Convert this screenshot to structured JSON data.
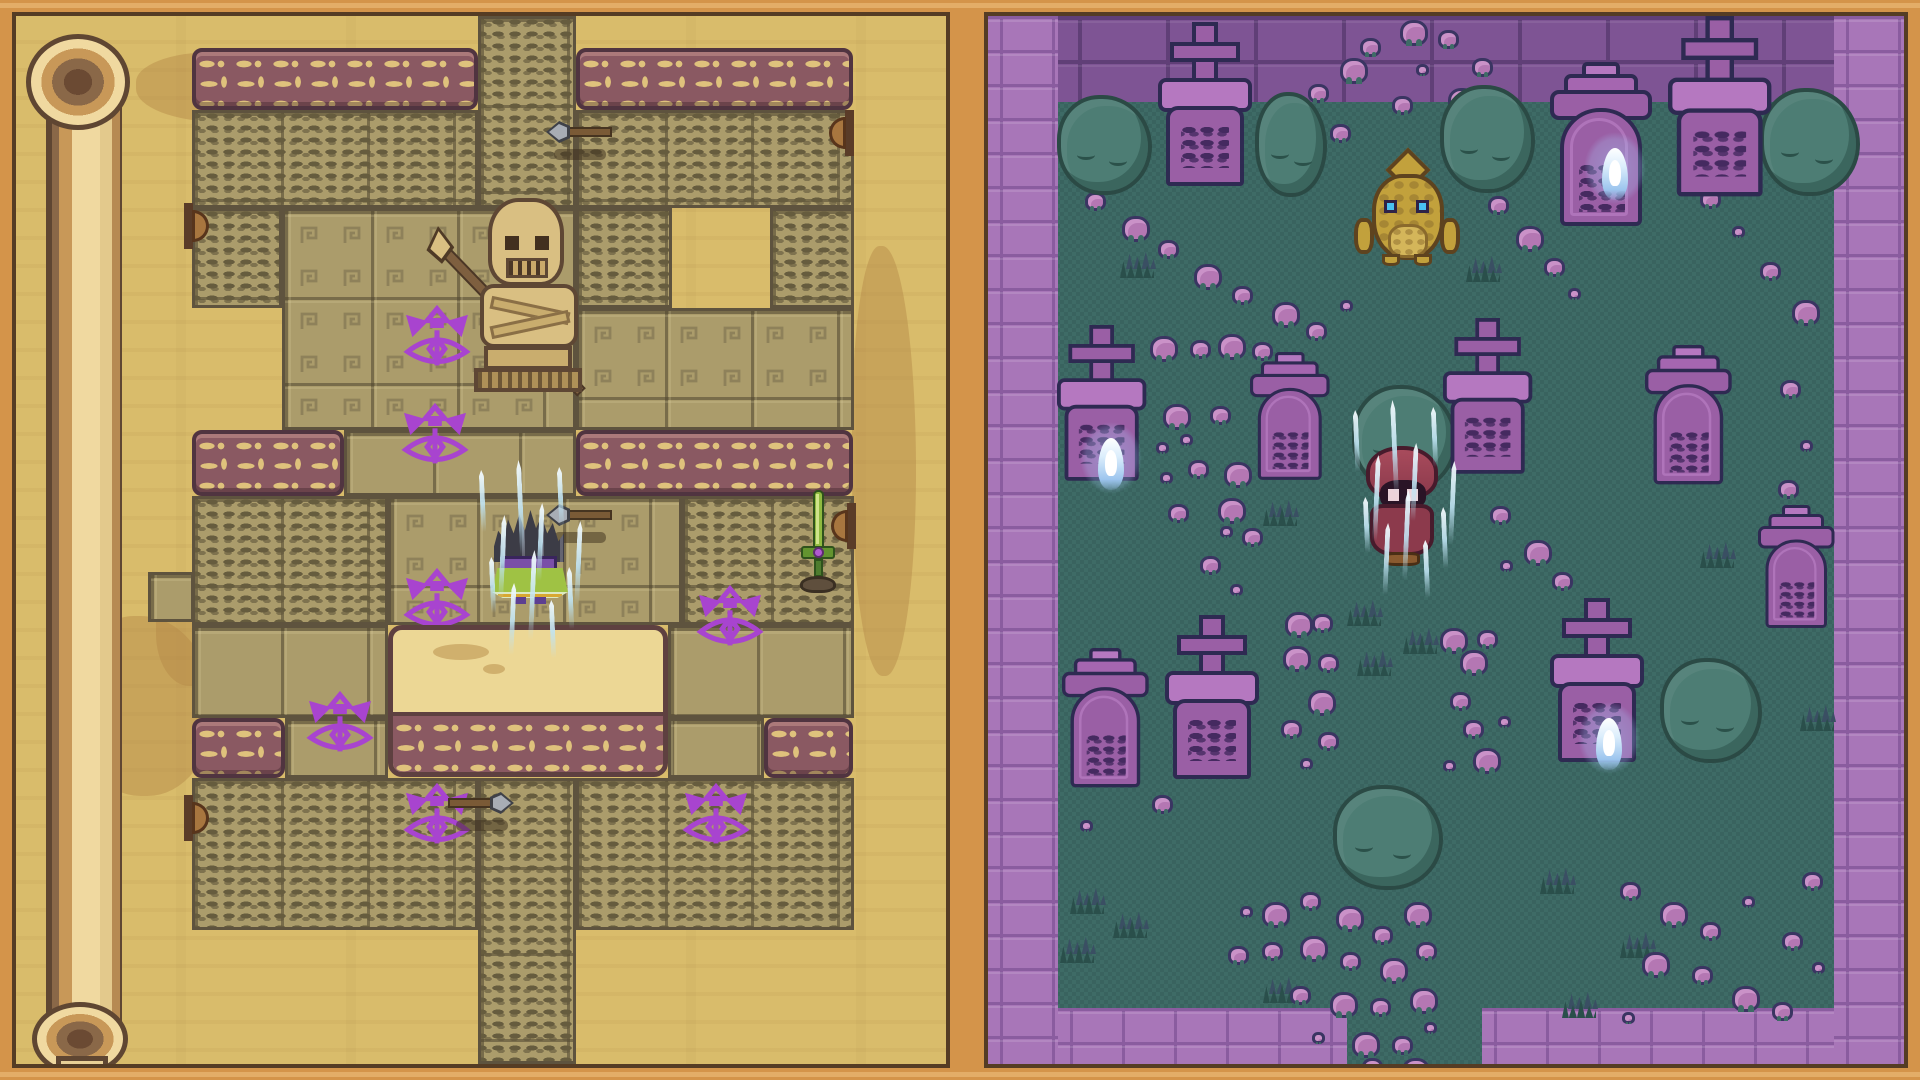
{
  "scene": {
    "kind": "pixel-art game, dual view: temple scroll map (left) and graveyard (right)",
    "width": 1920,
    "height": 1080,
    "visible_text": "none - all markings are decorative glyphs"
  },
  "palette": {
    "frame": "#d4944a",
    "frame-seam": "#553c24",
    "parchment": "#d9bc6b",
    "tile": "#ab9c6b",
    "glyph-mark": "#665c3e",
    "band": "#8a5962",
    "band-border": "#503440",
    "band-glyph": "#dfc27c",
    "plat": "#ecd795",
    "plat-border": "#5e4040",
    "eye": "#a844cf",
    "grass1": "#3e6b66",
    "grass2": "#39635f",
    "wallL": "#a876b8",
    "wallLseam": "#8a5c9f",
    "wallD": "#7e5494",
    "wallDseam": "#603f77",
    "bush": "#4d7d74",
    "bush-dark": "#2b4a45",
    "grave1": "#9a5fa5",
    "grave2": "#b578c0",
    "grave-outline": "#2e2a52",
    "engrave": "#452a60",
    "shroom": "#b477b3",
    "shroom-outline": "#3a3562",
    "tuft": "#2a4f4b",
    "statue": "#d9bf82",
    "statue-shade": "#c9ad6e",
    "statue-outline": "#5e4734",
    "player-cape": "#9fc244",
    "player-purple": "#7a4fa8",
    "hood-red": "#8c3a4c",
    "duck-gold": "#c2a13c",
    "sword-green": "#8fba3f",
    "wisp-blue": "#9cc5ee"
  },
  "left_panel": {
    "label": "temple-scroll-map",
    "origin": [
      16,
      16
    ],
    "blotches": [
      [
        58,
        600,
        140,
        180,
        0.5
      ],
      [
        836,
        230,
        64,
        430,
        0.3
      ],
      [
        120,
        36,
        180,
        70,
        0.4
      ],
      [
        140,
        560,
        70,
        110,
        0.5
      ],
      [
        360,
        300,
        30,
        18,
        0.6
      ]
    ],
    "scroll_curl": {
      "strip": [
        30,
        58,
        76,
        960
      ],
      "cap_top": [
        10,
        18,
        104,
        96
      ],
      "cap_bottom": [
        16,
        986,
        96,
        74
      ],
      "tail": [
        40,
        1040,
        52,
        24
      ]
    },
    "regions": [
      [
        "glyph",
        478,
        16,
        98,
        192
      ],
      [
        "band",
        192,
        48,
        286,
        62
      ],
      [
        "band",
        576,
        48,
        277,
        62
      ],
      [
        "glyph",
        192,
        110,
        286,
        98
      ],
      [
        "glyph",
        576,
        110,
        278,
        98
      ],
      [
        "glyph",
        192,
        208,
        90,
        100
      ],
      [
        "me",
        282,
        208,
        294,
        222
      ],
      [
        "glyph",
        576,
        208,
        96,
        100
      ],
      [
        "glyph",
        770,
        208,
        84,
        100
      ],
      [
        "me",
        576,
        308,
        278,
        122
      ],
      [
        "tiles",
        344,
        430,
        232,
        66
      ],
      [
        "band",
        192,
        430,
        152,
        66
      ],
      [
        "band",
        576,
        430,
        277,
        66
      ],
      [
        "glyph",
        192,
        496,
        196,
        129
      ],
      [
        "me",
        388,
        496,
        294,
        129
      ],
      [
        "glyph",
        682,
        496,
        172,
        129
      ],
      [
        "tiles",
        148,
        572,
        46,
        50
      ],
      [
        "tiles",
        192,
        625,
        196,
        93
      ],
      [
        "tiles",
        668,
        625,
        186,
        93
      ],
      [
        "tiles",
        285,
        718,
        103,
        60
      ],
      [
        "tiles",
        668,
        718,
        96,
        60
      ],
      [
        "band",
        192,
        718,
        93,
        60
      ],
      [
        "band",
        764,
        718,
        89,
        60
      ],
      [
        "glyph",
        192,
        778,
        286,
        152
      ],
      [
        "glyph",
        576,
        778,
        278,
        152
      ],
      [
        "glyph",
        478,
        778,
        98,
        286
      ]
    ],
    "eye_sigils": [
      [
        437,
        342
      ],
      [
        435,
        440
      ],
      [
        437,
        605
      ],
      [
        340,
        728
      ],
      [
        730,
        622
      ],
      [
        716,
        820
      ],
      [
        437,
        820
      ]
    ],
    "platform": {
      "x": 388,
      "y": 625,
      "w": 280,
      "h": 152,
      "band_h": 60
    },
    "statue": {
      "x": 452,
      "y": 188,
      "w": 140,
      "h": 206
    },
    "player": {
      "x": 492,
      "y": 510,
      "w": 76,
      "h": 94
    },
    "arrows": [
      {
        "x": 546,
        "y": 122,
        "dir": "left"
      },
      {
        "x": 546,
        "y": 505,
        "dir": "left"
      },
      {
        "x": 448,
        "y": 793,
        "dir": "right"
      }
    ],
    "sword": {
      "x": 794,
      "y": 490
    },
    "door_knobs": [
      {
        "x": 184,
        "y": 203,
        "side": "left"
      },
      {
        "x": 184,
        "y": 795,
        "side": "left"
      },
      {
        "x": 844,
        "y": 110,
        "side": "right"
      },
      {
        "x": 846,
        "y": 503,
        "side": "right"
      }
    ],
    "ice_cluster_center": [
      530,
      565
    ]
  },
  "right_panel": {
    "label": "graveyard",
    "origin": [
      988,
      16
    ],
    "walls": [
      [
        "dark",
        1058,
        16,
        776,
        86
      ],
      [
        "light",
        988,
        16,
        70,
        1048
      ],
      [
        "light",
        1834,
        16,
        70,
        1048
      ],
      [
        "light",
        1058,
        1008,
        289,
        56
      ],
      [
        "light",
        1482,
        1008,
        352,
        56
      ]
    ],
    "bushes": [
      [
        1057,
        95,
        95,
        100
      ],
      [
        1255,
        92,
        72,
        105
      ],
      [
        1440,
        85,
        95,
        108
      ],
      [
        1760,
        88,
        100,
        108
      ],
      [
        1352,
        385,
        105,
        108
      ],
      [
        1660,
        658,
        102,
        105
      ],
      [
        1333,
        785,
        110,
        105
      ]
    ],
    "gravestones": [
      {
        "x": 1158,
        "y": 22,
        "kind": "cross",
        "s": 1
      },
      {
        "x": 1668,
        "y": 16,
        "kind": "cross",
        "s": 1.1
      },
      {
        "x": 1550,
        "y": 62,
        "kind": "ornate",
        "s": 1
      },
      {
        "x": 1057,
        "y": 325,
        "kind": "cross",
        "s": 0.95
      },
      {
        "x": 1443,
        "y": 318,
        "kind": "cross",
        "s": 0.95
      },
      {
        "x": 1250,
        "y": 352,
        "kind": "ornate",
        "s": 0.78
      },
      {
        "x": 1645,
        "y": 345,
        "kind": "ornate",
        "s": 0.85
      },
      {
        "x": 1062,
        "y": 648,
        "kind": "ornate",
        "s": 0.85
      },
      {
        "x": 1165,
        "y": 615,
        "kind": "cross",
        "s": 1
      },
      {
        "x": 1550,
        "y": 598,
        "kind": "cross",
        "s": 1
      },
      {
        "x": 1758,
        "y": 505,
        "kind": "ornate",
        "s": 0.75
      }
    ],
    "wisps": [
      [
        1572,
        118
      ],
      [
        1068,
        408
      ],
      [
        1566,
        688
      ]
    ],
    "duck": {
      "x": 1352,
      "y": 148,
      "w": 112,
      "h": 122
    },
    "hooded_figure": {
      "x": 1358,
      "y": 440,
      "w": 92,
      "h": 126
    },
    "ice_cluster_center": [
      1404,
      505
    ],
    "mushrooms": [
      [
        1400,
        20,
        "l"
      ],
      [
        1438,
        30,
        "m"
      ],
      [
        1360,
        38,
        "m"
      ],
      [
        1472,
        58,
        "m"
      ],
      [
        1416,
        64,
        "s"
      ],
      [
        1448,
        88,
        "l"
      ],
      [
        1392,
        96,
        "m"
      ],
      [
        1470,
        118,
        "s"
      ],
      [
        1340,
        58,
        "l"
      ],
      [
        1308,
        84,
        "m"
      ],
      [
        1454,
        142,
        "m"
      ],
      [
        1484,
        164,
        "s"
      ],
      [
        1330,
        124,
        "m"
      ],
      [
        1488,
        196,
        "m"
      ],
      [
        1516,
        226,
        "l"
      ],
      [
        1544,
        258,
        "m"
      ],
      [
        1568,
        288,
        "s"
      ],
      [
        1085,
        192,
        "m"
      ],
      [
        1122,
        216,
        "l"
      ],
      [
        1158,
        240,
        "m"
      ],
      [
        1194,
        264,
        "l"
      ],
      [
        1232,
        286,
        "m"
      ],
      [
        1272,
        302,
        "l"
      ],
      [
        1306,
        322,
        "m"
      ],
      [
        1340,
        300,
        "s"
      ],
      [
        1700,
        190,
        "m"
      ],
      [
        1732,
        226,
        "s"
      ],
      [
        1760,
        262,
        "m"
      ],
      [
        1792,
        300,
        "l"
      ],
      [
        1780,
        380,
        "m"
      ],
      [
        1800,
        440,
        "s"
      ],
      [
        1778,
        480,
        "m"
      ],
      [
        1150,
        336,
        "l"
      ],
      [
        1190,
        340,
        "m"
      ],
      [
        1218,
        334,
        "l"
      ],
      [
        1252,
        342,
        "m"
      ],
      [
        1163,
        404,
        "l"
      ],
      [
        1210,
        406,
        "m"
      ],
      [
        1180,
        434,
        "s"
      ],
      [
        1156,
        442,
        "s"
      ],
      [
        1188,
        460,
        "m"
      ],
      [
        1224,
        462,
        "l"
      ],
      [
        1160,
        472,
        "s"
      ],
      [
        1168,
        504,
        "m"
      ],
      [
        1218,
        498,
        "l"
      ],
      [
        1220,
        526,
        "s"
      ],
      [
        1242,
        528,
        "m"
      ],
      [
        1200,
        556,
        "m"
      ],
      [
        1230,
        584,
        "s"
      ],
      [
        1490,
        506,
        "m"
      ],
      [
        1524,
        540,
        "l"
      ],
      [
        1552,
        572,
        "m"
      ],
      [
        1500,
        560,
        "s"
      ],
      [
        1285,
        612,
        "l"
      ],
      [
        1312,
        614,
        "m"
      ],
      [
        1283,
        646,
        "l"
      ],
      [
        1318,
        654,
        "m"
      ],
      [
        1308,
        690,
        "l"
      ],
      [
        1281,
        720,
        "m"
      ],
      [
        1318,
        732,
        "m"
      ],
      [
        1300,
        758,
        "s"
      ],
      [
        1440,
        628,
        "l"
      ],
      [
        1477,
        630,
        "m"
      ],
      [
        1460,
        650,
        "l"
      ],
      [
        1450,
        692,
        "m"
      ],
      [
        1463,
        720,
        "m"
      ],
      [
        1473,
        748,
        "l"
      ],
      [
        1443,
        760,
        "s"
      ],
      [
        1498,
        716,
        "s"
      ],
      [
        1090,
        742,
        "m"
      ],
      [
        1122,
        772,
        "s"
      ],
      [
        1152,
        795,
        "m"
      ],
      [
        1080,
        820,
        "s"
      ],
      [
        1262,
        902,
        "l"
      ],
      [
        1300,
        892,
        "m"
      ],
      [
        1336,
        906,
        "l"
      ],
      [
        1372,
        926,
        "m"
      ],
      [
        1404,
        902,
        "l"
      ],
      [
        1262,
        942,
        "m"
      ],
      [
        1300,
        936,
        "l"
      ],
      [
        1340,
        952,
        "m"
      ],
      [
        1380,
        958,
        "l"
      ],
      [
        1416,
        942,
        "m"
      ],
      [
        1290,
        986,
        "m"
      ],
      [
        1330,
        992,
        "l"
      ],
      [
        1370,
        998,
        "m"
      ],
      [
        1410,
        988,
        "l"
      ],
      [
        1352,
        1032,
        "l"
      ],
      [
        1392,
        1036,
        "m"
      ],
      [
        1424,
        1022,
        "s"
      ],
      [
        1312,
        1032,
        "s"
      ],
      [
        1362,
        1058,
        "m"
      ],
      [
        1402,
        1058,
        "l"
      ],
      [
        1240,
        906,
        "s"
      ],
      [
        1228,
        946,
        "m"
      ],
      [
        1620,
        882,
        "m"
      ],
      [
        1660,
        902,
        "l"
      ],
      [
        1700,
        922,
        "m"
      ],
      [
        1742,
        896,
        "s"
      ],
      [
        1782,
        932,
        "m"
      ],
      [
        1642,
        952,
        "l"
      ],
      [
        1692,
        966,
        "m"
      ],
      [
        1732,
        986,
        "l"
      ],
      [
        1772,
        1002,
        "m"
      ],
      [
        1622,
        1012,
        "s"
      ],
      [
        1812,
        962,
        "s"
      ],
      [
        1802,
        872,
        "m"
      ]
    ],
    "grass_tufts": [
      [
        1070,
        888
      ],
      [
        1113,
        912
      ],
      [
        1060,
        937
      ],
      [
        1263,
        977
      ],
      [
        1347,
        600
      ],
      [
        1403,
        628
      ],
      [
        1357,
        650
      ],
      [
        1263,
        500
      ],
      [
        1540,
        868
      ],
      [
        1800,
        705
      ],
      [
        1700,
        542
      ],
      [
        1466,
        256
      ],
      [
        1120,
        252
      ],
      [
        1620,
        932
      ],
      [
        1562,
        992
      ]
    ]
  }
}
